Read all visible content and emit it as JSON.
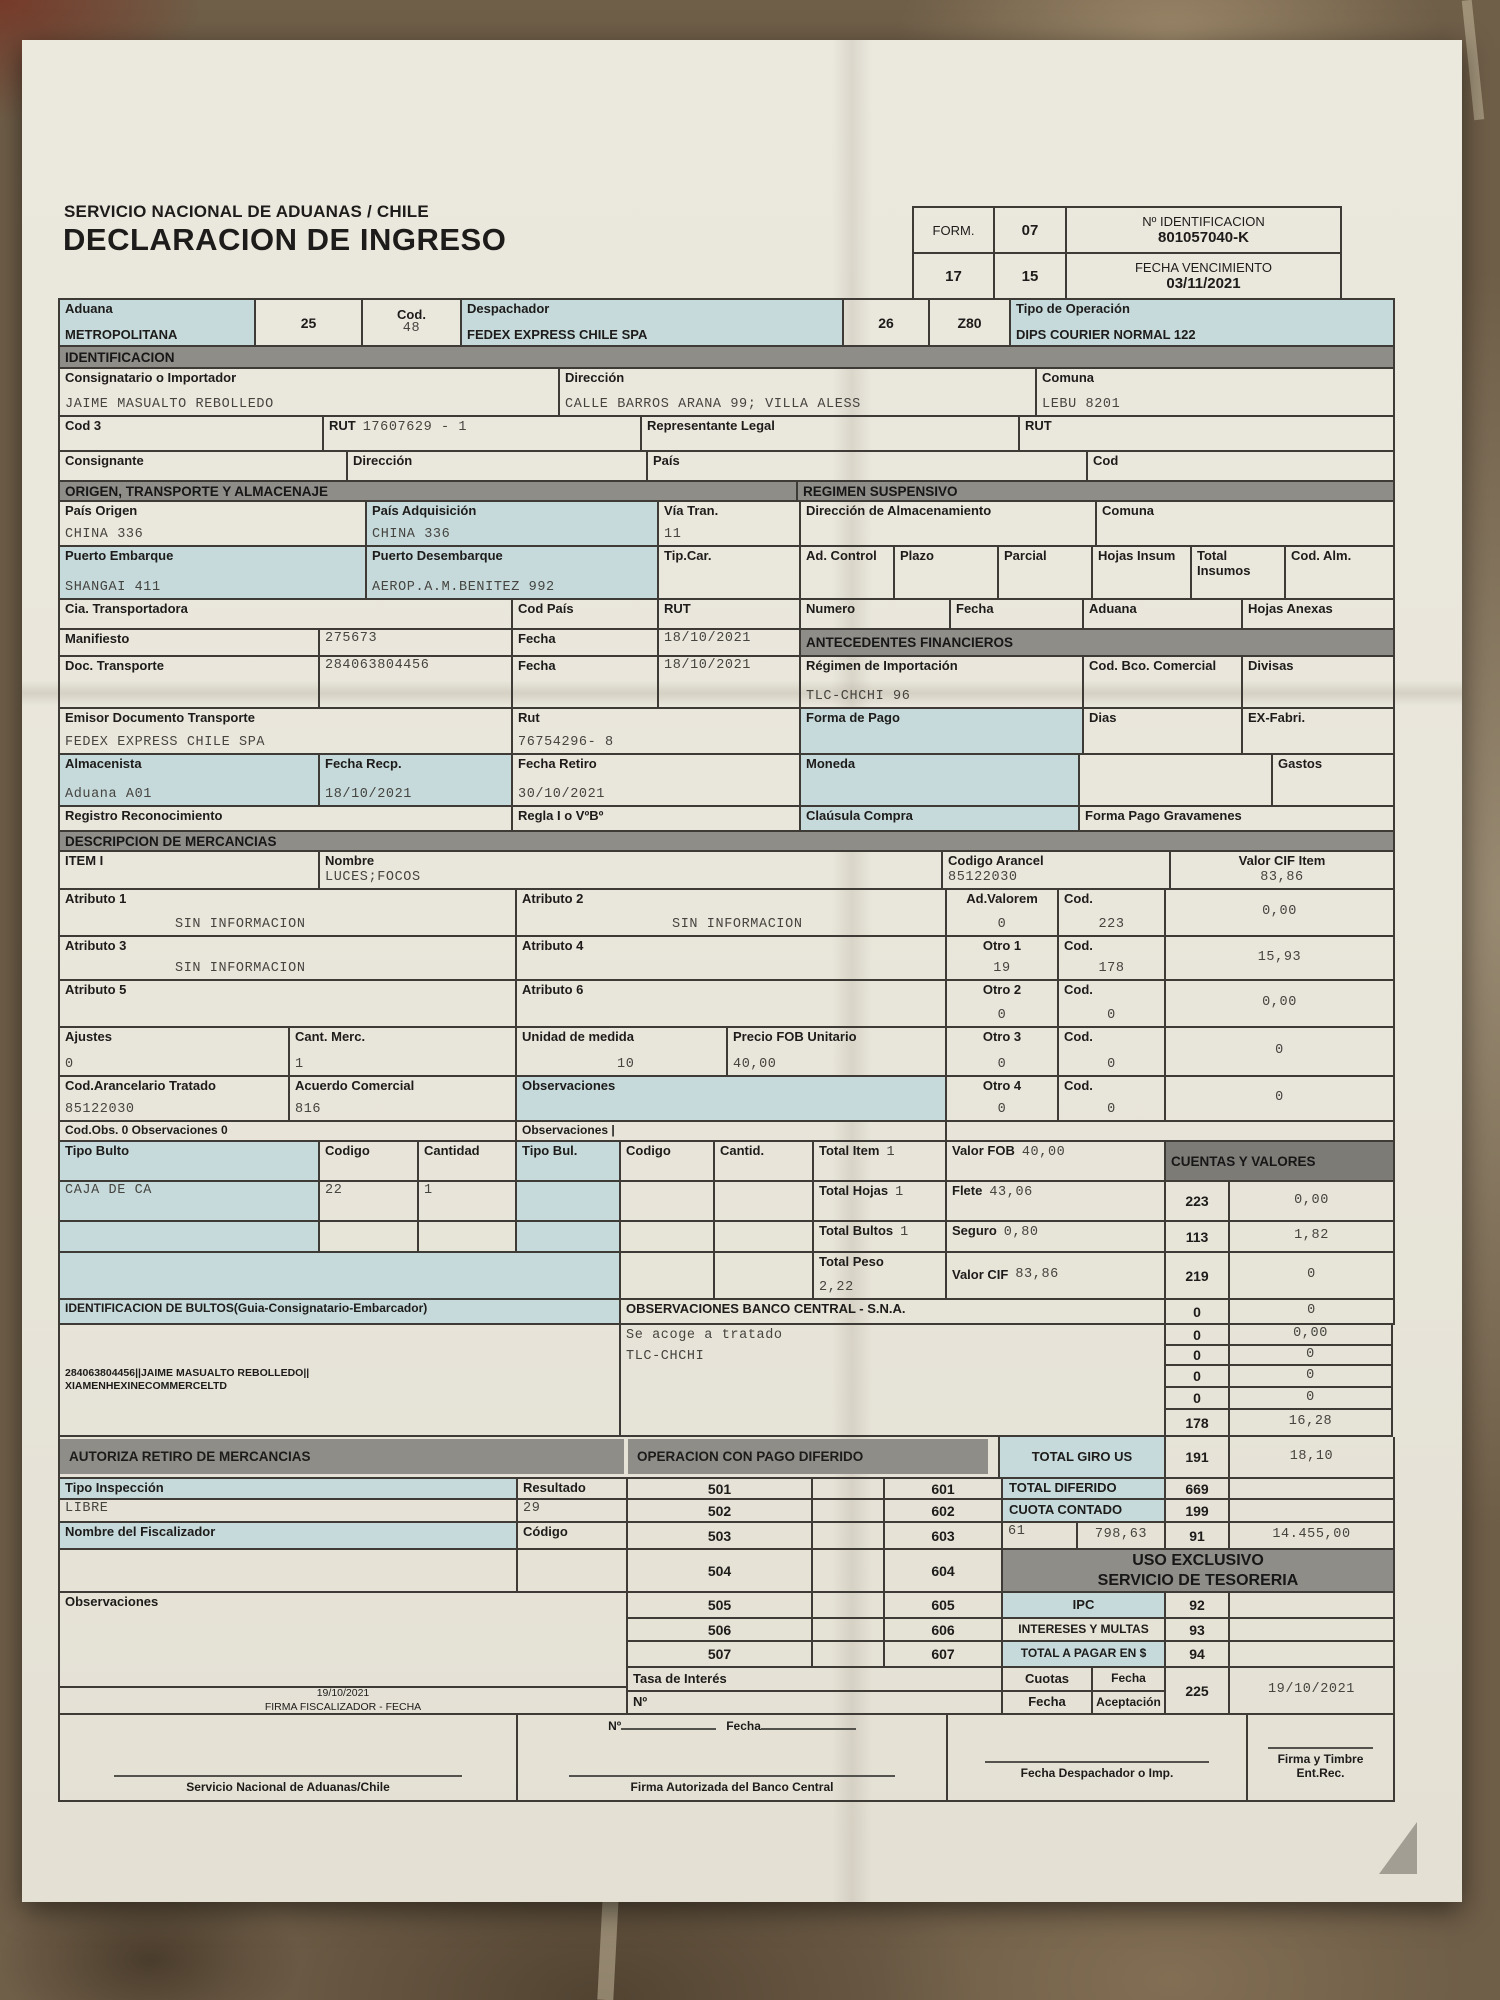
{
  "page": {
    "agency": "SERVICIO NACIONAL DE ADUANAS / CHILE",
    "title": "DECLARACION DE INGRESO",
    "form_label": "FORM.",
    "form_value": "07",
    "id_label": "Nº IDENTIFICACION",
    "id_value": "801057040-K",
    "box17": "17",
    "box15": "15",
    "venc_label": "FECHA VENCIMIENTO",
    "venc_value": "03/11/2021"
  },
  "topbar": {
    "aduana_label": "Aduana",
    "aduana_value": "METROPOLITANA",
    "n25": "25",
    "cod_label": "Cod.",
    "cod_value": "48",
    "despachador_label": "Despachador",
    "despachador_value": "FEDEX EXPRESS CHILE SPA",
    "n26": "26",
    "z80": "Z80",
    "tipo_label": "Tipo de Operación",
    "tipo_value": "DIPS COURIER NORMAL 122"
  },
  "ident": {
    "bar": "IDENTIFICACION",
    "consignatario_label": "Consignatario o Importador",
    "consignatario_value": "JAIME MASUALTO REBOLLEDO",
    "dir_label": "Dirección",
    "dir_value": "CALLE BARROS ARANA 99; VILLA ALESS",
    "comuna_label": "Comuna",
    "comuna_value": "LEBU 8201",
    "cod3_label": "Cod 3",
    "rut_label": "RUT",
    "rut_value": "17607629 - 1",
    "rep_label": "Representante Legal",
    "rut2_label": "RUT",
    "consignante_label": "Consignante",
    "dir2_label": "Dirección",
    "pais_label": "País",
    "cod_label": "Cod"
  },
  "origen": {
    "bar": "ORIGEN, TRANSPORTE Y ALMACENAJE",
    "bar2": "REGIMEN SUSPENSIVO",
    "pais_origen_label": "País Origen",
    "pais_origen_value": "CHINA 336",
    "pais_adq_label": "País Adquisición",
    "pais_adq_value": "CHINA 336",
    "via_label": "Vía Tran.",
    "via_value": "11",
    "dir_alm_label": "Dirección de Almacenamiento",
    "comuna_label": "Comuna",
    "pto_emb_label": "Puerto Embarque",
    "pto_emb_value": "SHANGAI 411",
    "pto_des_label": "Puerto Desembarque",
    "pto_des_value": "AEROP.A.M.BENITEZ 992",
    "tipcar_label": "Tip.Car.",
    "adcontrol_label": "Ad. Control",
    "plazo_label": "Plazo",
    "parcial_label": "Parcial",
    "hojas_label": "Hojas Insum",
    "total_label": "Total Insumos",
    "codalm_label": "Cod. Alm.",
    "cia_label": "Cia. Transportadora",
    "codpais_label": "Cod País",
    "rut_label": "RUT",
    "numero_label": "Numero",
    "fecha_label": "Fecha",
    "aduana_label": "Aduana",
    "hojas_anexas_label": "Hojas Anexas",
    "manifiesto_label": "Manifiesto",
    "manifiesto_value": "275673",
    "fecha1_label": "Fecha",
    "fecha1_value": "18/10/2021",
    "doc_label": "Doc. Transporte",
    "doc_value": "284063804456",
    "fecha2_label": "Fecha",
    "fecha2_value": "18/10/2021",
    "emisor_label": "Emisor Documento Transporte",
    "emisor_value": "FEDEX EXPRESS CHILE SPA",
    "rut2_label": "Rut",
    "rut2_value": "76754296- 8",
    "almacenista_label": "Almacenista",
    "almacenista_value": "Aduana A01",
    "fecha_recp_label": "Fecha Recp.",
    "fecha_recp_value": "18/10/2021",
    "fecha_ret_label": "Fecha Retiro",
    "fecha_ret_value": "30/10/2021",
    "registro_label": "Registro Reconocimiento",
    "regla_label": "Regla I o VºBº"
  },
  "fin": {
    "bar": "ANTECEDENTES FINANCIEROS",
    "regimen_label": "Régimen de Importación",
    "regimen_value": "TLC-CHCHI 96",
    "codbco_label": "Cod. Bco. Comercial",
    "divisas_label": "Divisas",
    "forma_label": "Forma de Pago",
    "dias_label": "Dias",
    "exfabri_label": "EX-Fabri.",
    "moneda_label": "Moneda",
    "gastos_label": "Gastos",
    "clausula_label": "Claúsula Compra",
    "gravamenes_label": "Forma Pago Gravamenes"
  },
  "merc": {
    "bar": "DESCRIPCION DE MERCANCIAS",
    "item_label": "ITEM I",
    "nombre_label": "Nombre",
    "nombre_value": "LUCES;FOCOS",
    "arancel_label": "Codigo Arancel",
    "arancel_value": "85122030",
    "cif_label": "Valor CIF Item",
    "cif_value": "83,86",
    "atr1_label": "Atributo 1",
    "atr1_value": "SIN INFORMACION",
    "atr2_label": "Atributo 2",
    "atr2_value": "SIN INFORMACION",
    "advalorem_label": "Ad.Valorem",
    "advalorem_value": "0",
    "cod1_label": "Cod.",
    "cod1_value": "223",
    "v1": "0,00",
    "atr3_label": "Atributo 3",
    "atr3_value": "SIN INFORMACION",
    "atr4_label": "Atributo 4",
    "otro1_label": "Otro 1",
    "otro1_value": "19",
    "cod2_label": "Cod.",
    "cod2_value": "178",
    "v2": "15,93",
    "atr5_label": "Atributo 5",
    "atr6_label": "Atributo 6",
    "otro2_label": "Otro 2",
    "otro2_value": "0",
    "cod3_label": "Cod.",
    "cod3_value": "0",
    "v3": "0,00",
    "ajustes_label": "Ajustes",
    "ajustes_value": "0",
    "cant_label": "Cant. Merc.",
    "cant_value": "1",
    "unidad_label": "Unidad de medida",
    "unidad_value": "10",
    "fob_label": "Precio FOB Unitario",
    "fob_value": "40,00",
    "otro3_label": "Otro 3",
    "otro3_value": "0",
    "cod4_label": "Cod.",
    "cod4_value": "0",
    "v4": "0",
    "trat_label": "Cod.Arancelario Tratado",
    "trat_value": "85122030",
    "acuerdo_label": "Acuerdo Comercial",
    "acuerdo_value": "816",
    "obs_label": "Observaciones",
    "otro4_label": "Otro 4",
    "otro4_value": "0",
    "cod5_label": "Cod.",
    "cod5_value": "0",
    "v5": "0",
    "codobs_label": "Cod.Obs. 0 Observaciones 0",
    "obs2_label": "Observaciones |"
  },
  "bultos": {
    "tipo_label": "Tipo Bulto",
    "codigo_label": "Codigo",
    "cantidad_label": "Cantidad",
    "tipo2_label": "Tipo Bul.",
    "codigo2_label": "Codigo",
    "cantid_label": "Cantid.",
    "total_item_label": "Total Item",
    "total_item_value": "1",
    "fob_label": "Valor FOB",
    "fob_value": "40,00",
    "cuentas_bar": "CUENTAS Y VALORES",
    "tipo_value": "CAJA DE CA",
    "codigo_value": "22",
    "cantidad_value": "1",
    "hojas_label": "Total Hojas",
    "hojas_value": "1",
    "flete_label": "Flete",
    "flete_value": "43,06",
    "bultos_label": "Total Bultos",
    "bultos_value": "1",
    "seguro_label": "Seguro",
    "seguro_value": "0,80",
    "peso_label": "Total Peso",
    "peso_value": "2,22",
    "cif_label": "Valor CIF",
    "cif_value": "83,86",
    "ident_label": "IDENTIFICACION DE BULTOS(Guia-Consignatario-Embarcador)",
    "ident_line1": "284063804456||JAIME MASUALTO REBOLLEDO||",
    "ident_line2": "XIAMENHEXINECOMMERCELTD",
    "obs_bar": "OBSERVACIONES BANCO CENTRAL - S.N.A.",
    "acoge_line1": "Se acoge a tratado",
    "acoge_line2": "TLC-CHCHI"
  },
  "cuentas": {
    "r1c": "223",
    "r1v": "0,00",
    "r2c": "113",
    "r2v": "1,82",
    "r3c": "219",
    "r3v": "0",
    "r4c": "0",
    "r4v": "0",
    "r5c": "0",
    "r5v": "0,00",
    "r6c": "0",
    "r6v": "0",
    "r7c": "0",
    "r7v": "0",
    "r8c": "0",
    "r8v": "0",
    "r9c": "178",
    "r9v": "16,28",
    "r10c": "191",
    "r10v": "18,10"
  },
  "autoriza": {
    "bar": "AUTORIZA RETIRO DE MERCANCIAS",
    "bar2": "OPERACION CON PAGO DIFERIDO",
    "giro_label": "TOTAL GIRO US"
  },
  "insp": {
    "tipo_label": "Tipo Inspección",
    "resultado_label": "Resultado",
    "tipo_value": "LIBRE",
    "resultado_value": "29",
    "fisc_label": "Nombre del Fiscalizador",
    "codigo_label": "Código",
    "obs_label": "Observaciones",
    "firma_fecha": "19/10/2021",
    "firma_label": "FIRMA FISCALIZADOR - FECHA"
  },
  "cod": {
    "l1": "501",
    "l2": "502",
    "l3": "503",
    "l4": "504",
    "l5": "505",
    "l6": "506",
    "l7": "507",
    "r1": "601",
    "r2": "602",
    "r3": "603",
    "r4": "604",
    "r5": "605",
    "r6": "606",
    "r7": "607",
    "tasa_label": "Tasa de Interés",
    "no_label": "Nº"
  },
  "tes": {
    "dif_label": "TOTAL DIFERIDO",
    "dif_code": "669",
    "cuota_label": "CUOTA CONTADO",
    "cuota_code": "199",
    "r61": "61",
    "r61v": "798,63",
    "r61c": "91",
    "r61t": "14.455,00",
    "uso1": "USO EXCLUSIVO",
    "uso2": "SERVICIO DE TESORERIA",
    "ipc_label": "IPC",
    "ipc_code": "92",
    "int_label": "INTERESES Y MULTAS",
    "int_code": "93",
    "pagar_label": "TOTAL A PAGAR EN $",
    "pagar_code": "94",
    "cuotas_label": "Cuotas",
    "fecha_label": "Fecha",
    "fecha2_label": "Fecha",
    "acept_label": "Aceptación",
    "c225": "225",
    "fecha_value": "19/10/2021"
  },
  "firmas": {
    "no_label": "Nº",
    "fecha_label": "Fecha",
    "b1": "Servicio Nacional de Aduanas/Chile",
    "b2": "Firma Autorizada del Banco Central",
    "b3": "Fecha Despachador o Imp.",
    "b4": "Firma y Timbre Ent.Rec."
  },
  "colors": {
    "teal": "#c6dadb",
    "bar_gray": "#8f8d88",
    "border": "#3e3b36",
    "paper": "#e9e6db"
  }
}
